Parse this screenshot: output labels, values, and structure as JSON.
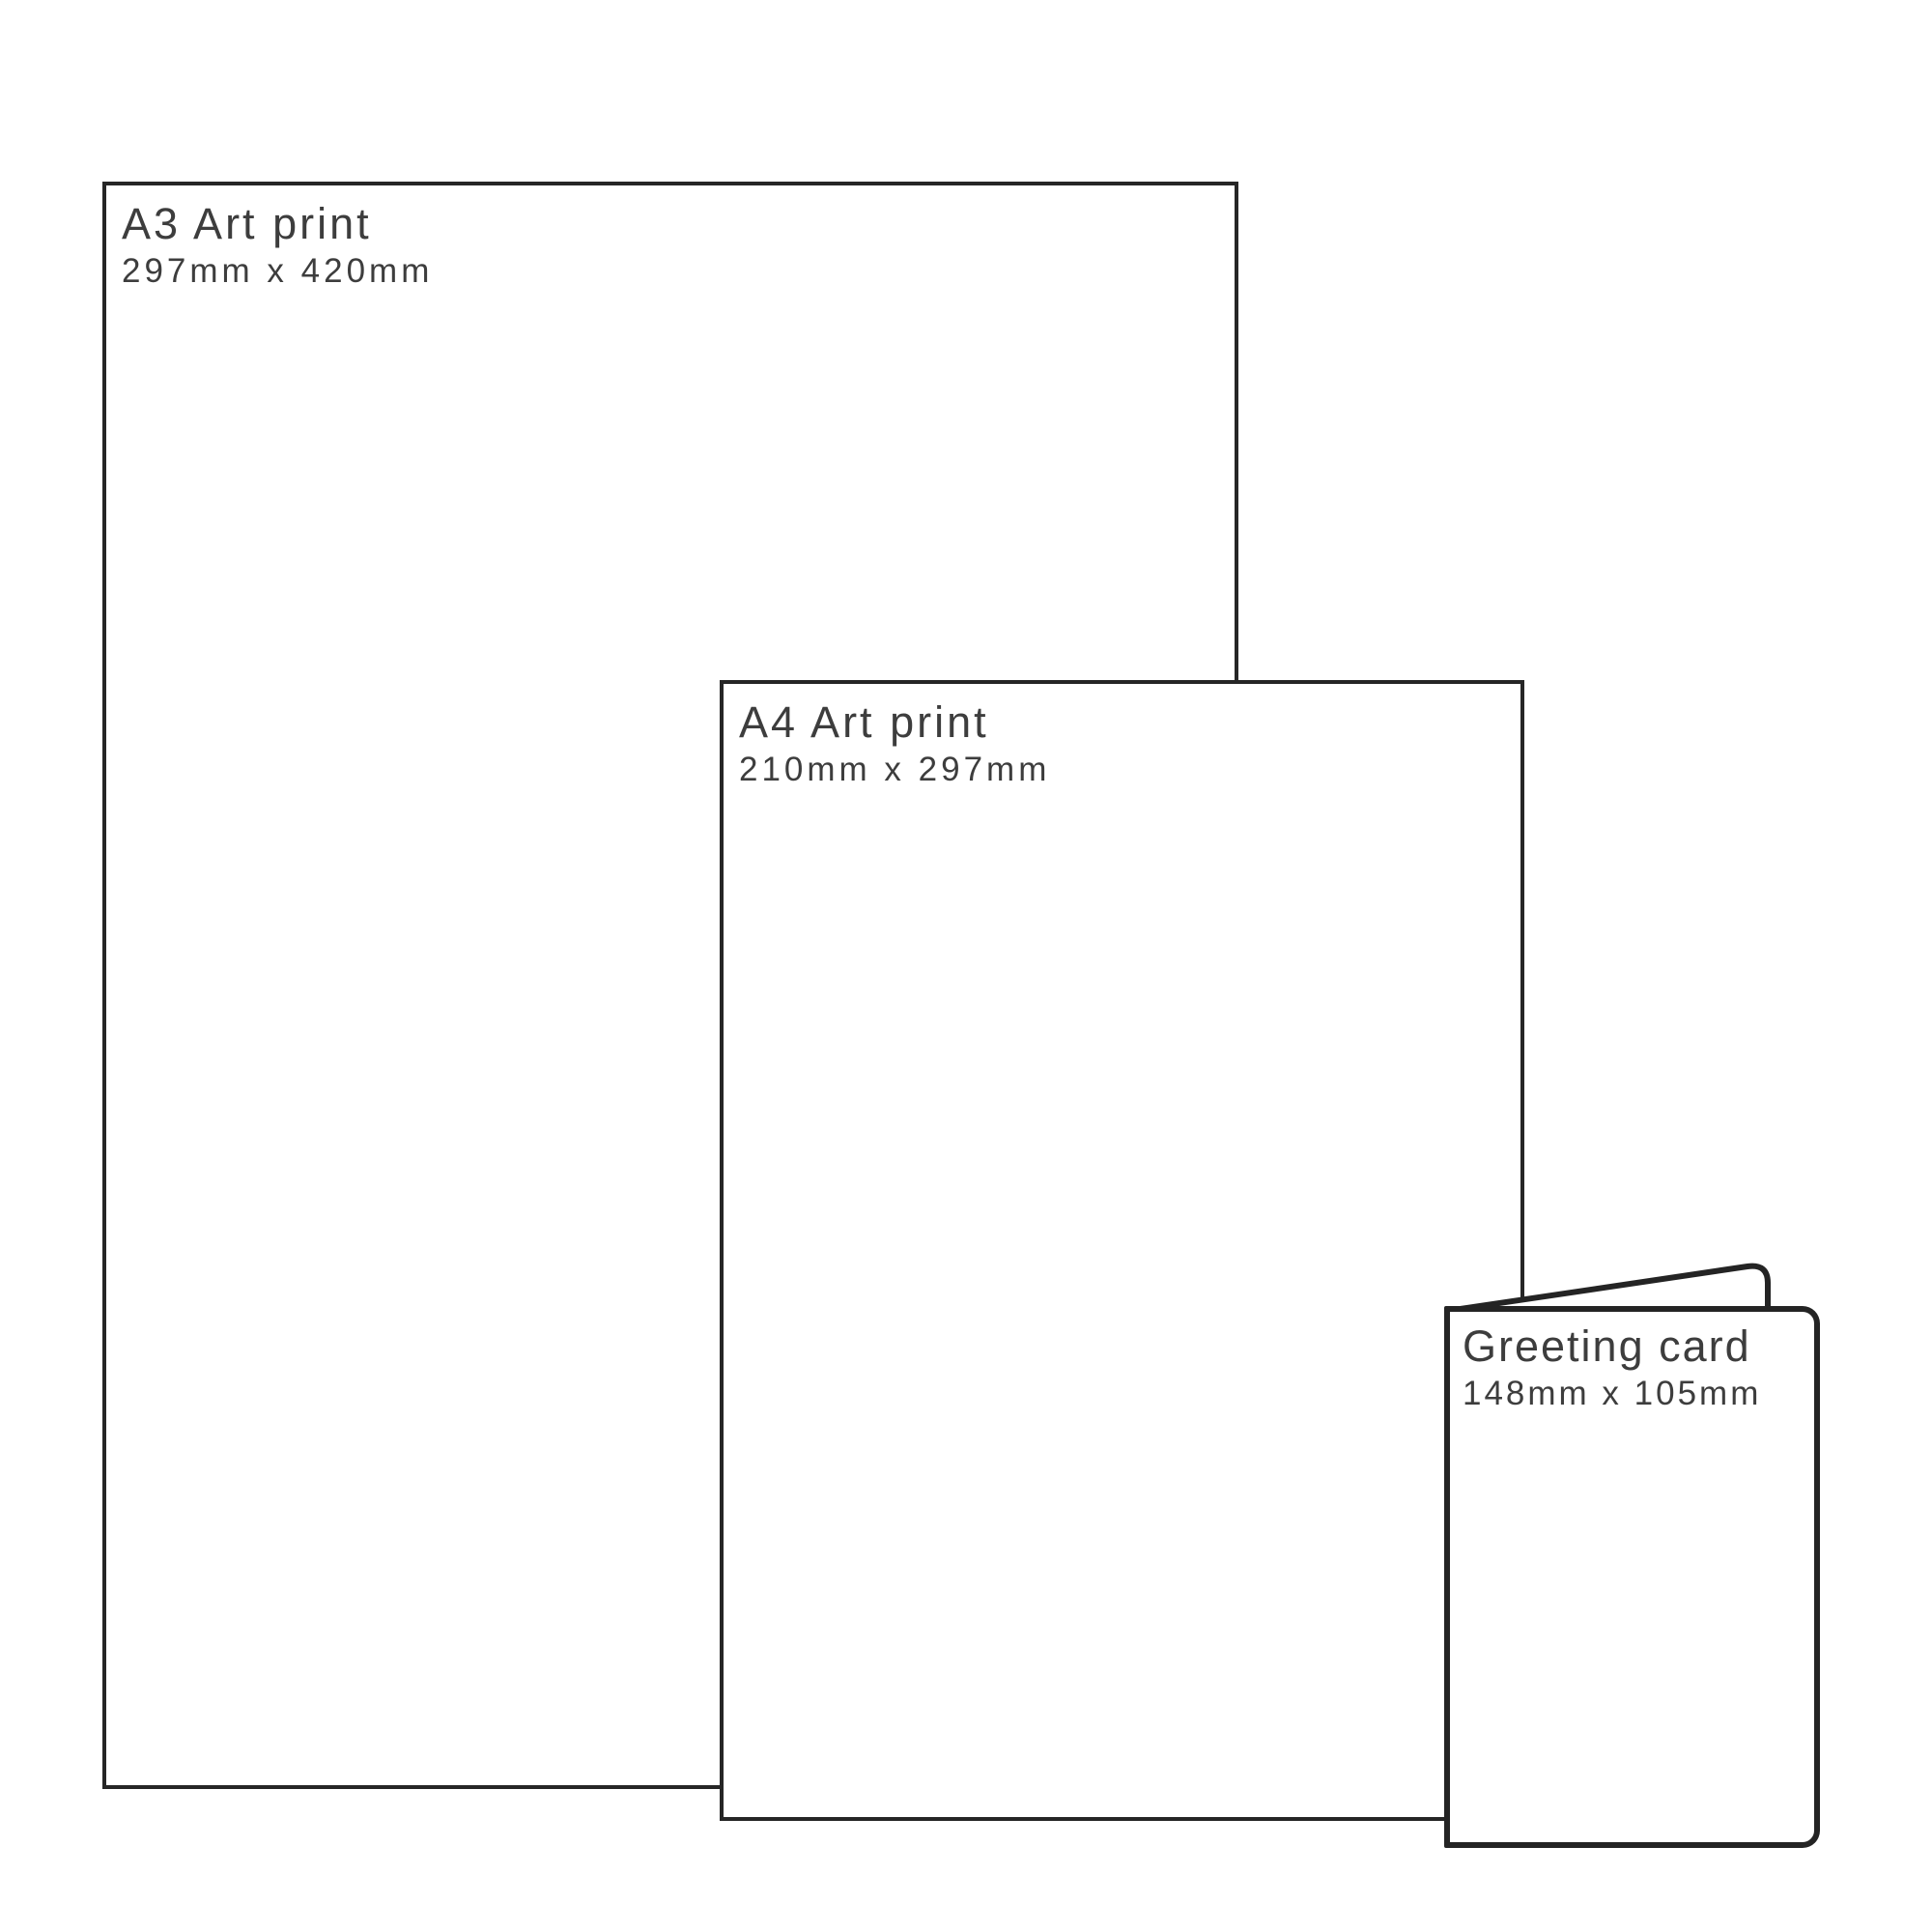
{
  "page": {
    "background_color": "#ffffff",
    "sheet_outline_color": "#262626",
    "card_outline_color": "#242424",
    "text_color": "#3d3d3d"
  },
  "products": [
    {
      "name": "A3 Art print",
      "size": "297mm x 420mm"
    },
    {
      "name": "A4 Art print",
      "size": "210mm x 297mm"
    },
    {
      "name": "Greeting card",
      "size": "148mm x 105mm"
    }
  ]
}
